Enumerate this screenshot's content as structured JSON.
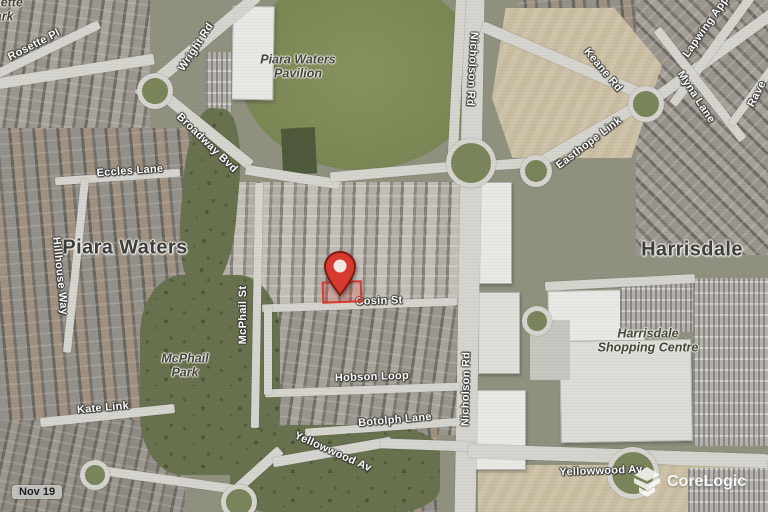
{
  "map": {
    "suburbs": {
      "piara_waters": "Piara Waters",
      "harrisdale": "Harrisdale"
    },
    "places": {
      "rosette_park": "Rosette Park",
      "pavilion": "Piara Waters Pavilion",
      "mcphail_park": "McPhail Park",
      "shopping_centre": "Harrisdale Shopping Centre"
    },
    "streets": {
      "rosette_pl": "Rosette Pl",
      "wright_rd": "Wright Rd",
      "broadway_bvd": "Broadway Bvd",
      "eccles_lane": "Eccles Lane",
      "hillhouse_way": "Hillhouse Way",
      "mcphail_st": "McPhail St",
      "kate_link": "Kate Link",
      "cosin_st": "Cosin St",
      "hobson_loop": "Hobson Loop",
      "botolph_lane": "Botolph Lane",
      "yellowwood_av_west": "Yellowwood Av",
      "yellowwood_av_east": "Yellowwood Av",
      "nicholson_rd_north": "Nicholson Rd",
      "nicholson_rd_south": "Nicholson Rd",
      "keane_rd": "Keane Rd",
      "easthope_link": "Easthope Link",
      "lapwing_app_partial": "Lapwing App",
      "myna_lane": "Myna Lane",
      "raven_partial": "Rave"
    },
    "overlays": {
      "date_label": "Nov 19",
      "watermark": "CoreLogic"
    },
    "colors": {
      "pin": "#d93a2f",
      "parcel_outline": "#d93a2f",
      "road": "#d5d4ce",
      "field_green": "#7c8857",
      "scrub_green": "#68724e",
      "sand": "#c9bda1",
      "street_text": "#fdfdfb",
      "suburb_text": "#3d3d3c",
      "watermark_text": "#ffffff"
    }
  }
}
